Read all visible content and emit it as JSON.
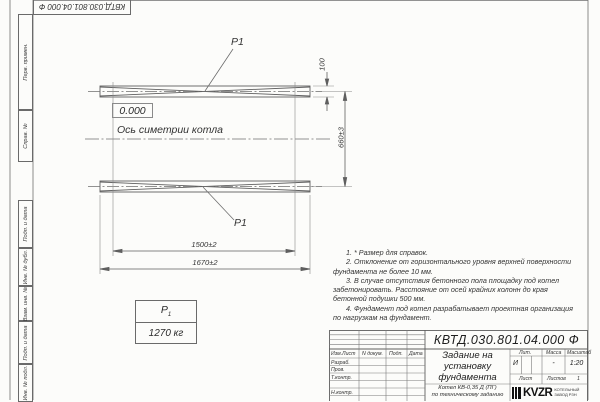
{
  "page": {
    "top_designation": "КВТД.030.801.04.000 Ф"
  },
  "stamps": {
    "perv_primen": "Перв. примен.",
    "sprav_n": "Справ. №",
    "podp_data_1": "Подп. и дата",
    "inv_dubl": "Инв. № дубл.",
    "vzam_inv": "Взам. инв. №",
    "podp_data_2": "Подп. и дата",
    "inv_podl": "Инв. № подл."
  },
  "drawing": {
    "p1_top": "P1",
    "p1_bottom": "P1",
    "level_mark": "0.000",
    "axis_label": "Ось симетрии котла",
    "dim_width": "100",
    "dim_spacing": "660±3",
    "dim_bolts": "1500±2",
    "dim_length": "1670±2"
  },
  "load_table": {
    "name": "P",
    "index": "1",
    "value": "1270 кг"
  },
  "notes": [
    "1. * Размер для справок.",
    "2. Отклонение от горизонтального уровня верхней поверхности фундамента не более 10 мм.",
    "3. В случае отсутствия бетонного пола площадку под котел забетонировать. Расстояние от осей крайних колонн до края бетонной подушки 500 мм.",
    "4. Фундамент под котел разрабатывает проектная организация по нагрузкам на фундамент."
  ],
  "title_block": {
    "doc_number": "КВТД.030.801.04.000 Ф",
    "title": "Задание на установку фундамента",
    "subject_line1": "Котел КВ-0,35 Д (ПГ)",
    "subject_line2": "по техническому заданию",
    "header_row": [
      "Изм.Лист",
      "N докум.",
      "Подп.",
      "Дата"
    ],
    "rows": [
      "Разраб.",
      "Пров.",
      "Т.контр.",
      "Н.контр."
    ],
    "lit_label": "Лит.",
    "lit_value": "И",
    "mass_label": "Масса",
    "mass_value": "-",
    "scale_label": "Масштаб",
    "scale_value": "1:20",
    "sheet_label": "Лист",
    "sheets_label": "Листов",
    "sheets_value": "1",
    "logo_text": "KVZR",
    "logo_sub1": "КОТЕЛЬНЫЙ",
    "logo_sub2": "ЗАВОД РЗН"
  }
}
